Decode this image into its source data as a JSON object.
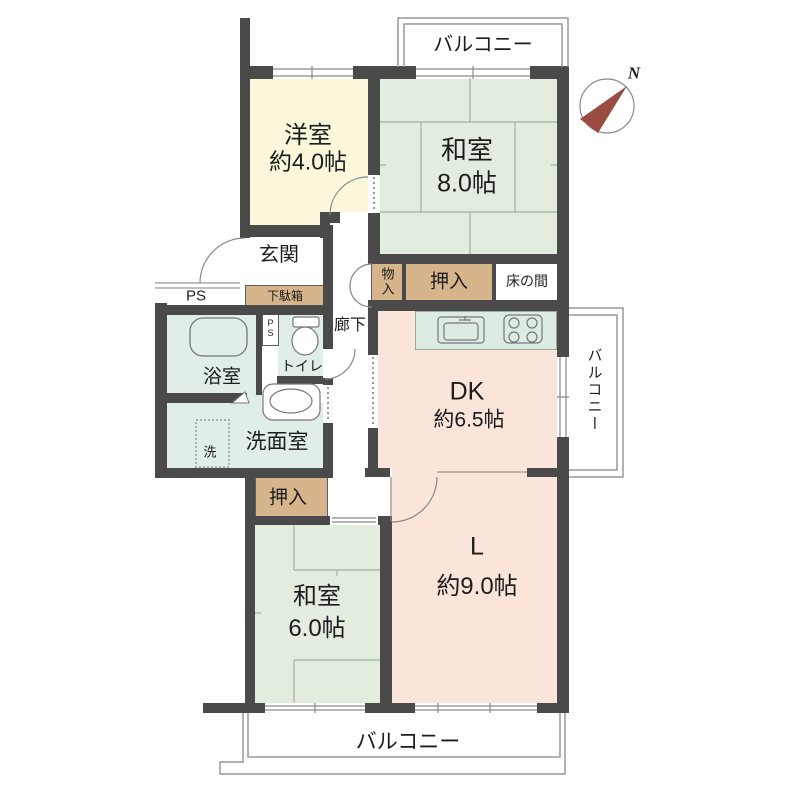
{
  "colors": {
    "wall": "#4a4a4a",
    "western": "#faf7da",
    "tatami": "#e2ede0",
    "bath": "#e1eee7",
    "pink": "#fbe4da",
    "tan": "#d7b58c",
    "counter": "#dcece3",
    "fence": "#999999",
    "north_arrow": "#9b4c42"
  },
  "compass": {
    "label": "N"
  },
  "balconies": {
    "top": "バルコニー",
    "right": "バルコニー",
    "bottom": "バルコニー"
  },
  "rooms": {
    "western": {
      "name": "洋室",
      "size": "約4.0帖"
    },
    "tatami8": {
      "name": "和室",
      "size": "8.0帖"
    },
    "tatami6": {
      "name": "和室",
      "size": "6.0帖"
    },
    "living": {
      "name": "L",
      "size": "約9.0帖"
    },
    "dk": {
      "name": "DK",
      "size": "約6.5帖"
    },
    "entrance": {
      "name": "玄関"
    },
    "hallway": {
      "name": "廊下"
    },
    "bathroom": {
      "name": "浴室"
    },
    "toilet": {
      "name": "トイレ"
    },
    "washroom": {
      "name": "洗面室"
    },
    "washer": {
      "name": "洗"
    }
  },
  "storage": {
    "shoe_cabinet": "下駄箱",
    "mono_ire": "物入",
    "oshiire_top": "押入",
    "oshiire_bottom": "押入",
    "tokonoma": "床の間"
  },
  "utility": {
    "ps_outer": "PS",
    "ps_inner": "PS"
  }
}
